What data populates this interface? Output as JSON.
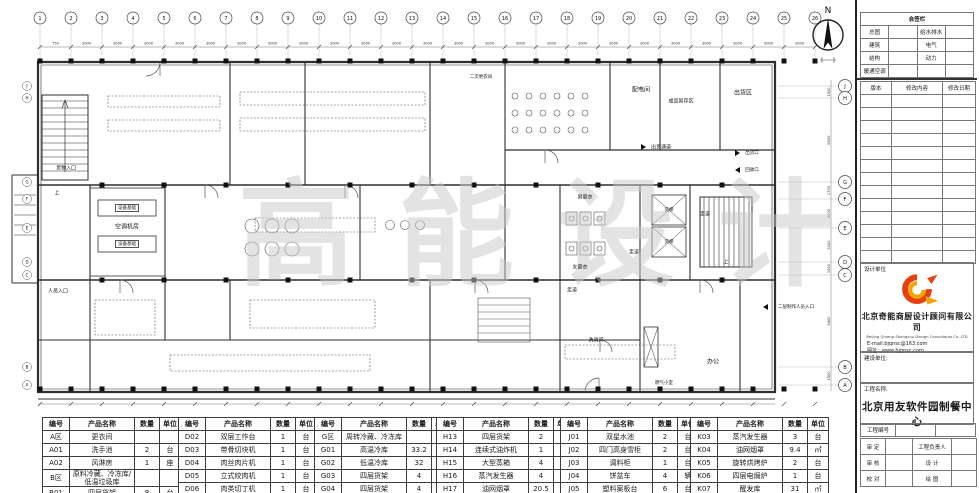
{
  "plan": {
    "north_label": "N",
    "watermark": "高能设计",
    "grid": {
      "top_numbers": [
        "1",
        "2",
        "3",
        "4",
        "5",
        "6",
        "7",
        "8",
        "9",
        "10",
        "11",
        "12",
        "13",
        "14",
        "15",
        "16",
        "17",
        "18",
        "19",
        "20",
        "21",
        "22",
        "23",
        "24",
        "25",
        "26"
      ],
      "top_dims": [
        "750",
        "3000",
        "3000",
        "3000",
        "3000",
        "3000",
        "3000",
        "3000",
        "3000",
        "3000",
        "3000",
        "3000",
        "3000",
        "3000",
        "3000",
        "3000",
        "3000",
        "3000",
        "3000",
        "3000",
        "3000",
        "3000",
        "3000",
        "3000",
        "3000"
      ],
      "right_letters": [
        "J",
        "H",
        "G",
        "F",
        "E",
        "D",
        "C",
        "B",
        "A"
      ],
      "right_dims": [
        "1500",
        "6000",
        "1700",
        "3000",
        "3000",
        "1500",
        "5400",
        "1500"
      ]
    },
    "labels": {
      "goods_entrance": "货物入口",
      "staff_entrance": "人员入口",
      "equipment_base": "设备基础",
      "ac_room": "空调机房",
      "second_dressing": "二次更衣间",
      "power_room": "配电间",
      "finished_storage": "成品暂存区",
      "shipping_area": "出货区",
      "shipping_corridor": "出货通道",
      "shipping_port": "出货口",
      "recycle_port": "回收口",
      "male_dressing": "男更衣",
      "female_dressing": "女更衣",
      "corridor": "走道",
      "freight_elevator": "货梯",
      "up": "上",
      "office": "办公",
      "gas_room": "燃气小室",
      "washing_room": "洗消间",
      "second_floor_entrance": "二层制作人员入口"
    }
  },
  "equipment_headers": [
    "编号",
    "产品名称",
    "数量",
    "单位"
  ],
  "equipment_tables": [
    {
      "rows": [
        [
          "A区",
          "更衣间",
          "",
          ""
        ],
        [
          "A01",
          "洗手池",
          "2",
          "台"
        ],
        [
          "A02",
          "风淋房",
          "1",
          "座"
        ],
        [
          "B区",
          "原料冷藏、冷冻库/低温垃圾库",
          "",
          ""
        ],
        [
          "B01",
          "四层货架",
          "8",
          "台"
        ]
      ]
    },
    {
      "rows": [
        [
          "D02",
          "双层工作台",
          "1",
          "台"
        ],
        [
          "D03",
          "带骨切块机",
          "1",
          "台"
        ],
        [
          "D04",
          "肉丝肉片机",
          "1",
          "台"
        ],
        [
          "D05",
          "立式绞肉机",
          "1",
          "台"
        ],
        [
          "D06",
          "肉类切丁机",
          "1",
          "台"
        ]
      ]
    },
    {
      "rows": [
        [
          "G区",
          "周转冷藏、冷冻库",
          "",
          ""
        ],
        [
          "G01",
          "高温冷库",
          "33.2",
          "㎡"
        ],
        [
          "G02",
          "低温冷库",
          "32",
          "㎡"
        ],
        [
          "G03",
          "四层货架",
          "4",
          "台"
        ],
        [
          "G04",
          "四层货架",
          "4",
          "台"
        ]
      ]
    },
    {
      "rows": [
        [
          "H13",
          "四层货架",
          "2",
          "台"
        ],
        [
          "H14",
          "连续式油炸机",
          "1",
          "台"
        ],
        [
          "H15",
          "大型蒸箱",
          "4",
          "台"
        ],
        [
          "H16",
          "蒸汽发生器",
          "4",
          "台"
        ],
        [
          "H17",
          "油网烟罩",
          "20.5",
          "㎡"
        ]
      ]
    },
    {
      "rows": [
        [
          "J01",
          "双星水池",
          "2",
          "台"
        ],
        [
          "J02",
          "四门高身雪柜",
          "2",
          "台"
        ],
        [
          "J03",
          "调料柜",
          "1",
          "台"
        ],
        [
          "J04",
          "饼盆车",
          "4",
          "辆"
        ],
        [
          "J05",
          "塑料案板台",
          "6",
          "台"
        ]
      ]
    },
    {
      "rows": [
        [
          "K03",
          "蒸汽发生器",
          "3",
          "台"
        ],
        [
          "K04",
          "油网烟罩",
          "9.4",
          "㎡"
        ],
        [
          "K05",
          "旋转烘烤炉",
          "2",
          "台"
        ],
        [
          "K06",
          "四层电焗炉",
          "1",
          "台"
        ],
        [
          "K07",
          "醒发库",
          "31",
          "㎡"
        ]
      ]
    }
  ],
  "title_block": {
    "sign_table": {
      "title": "会签栏",
      "rows": [
        [
          "总图",
          "",
          "给水排水",
          ""
        ],
        [
          "建筑",
          "",
          "电气",
          ""
        ],
        [
          "结构",
          "",
          "动力",
          ""
        ],
        [
          "暖通空调",
          "",
          "",
          ""
        ]
      ]
    },
    "revision_table": {
      "headers": [
        "版本",
        "修改内容",
        "修改日期"
      ],
      "empty_rows": 13
    },
    "design_unit_label": "设计单位",
    "company_cn": "北京奇能商厨设计顾问有限公司",
    "company_en": "Beijing Qineng Shangchu Design Consultants Co.,LTD",
    "email": "E-mail:bjqnsc@163.com",
    "website": "网址：www.bjqnsc.com",
    "build_unit_label": "建设单位:",
    "project_name_label": "工程名称:",
    "project_name": "北京用友软件园制餐中心",
    "project_no_row": [
      "工程编号",
      "",
      ""
    ],
    "approval_rows": [
      [
        "审 定",
        "",
        "工程负责人",
        ""
      ],
      [
        "审 核",
        "",
        "设 计",
        ""
      ],
      [
        "校 对",
        "",
        "绘 图",
        ""
      ]
    ]
  },
  "colors": {
    "line": "#2f2f2f",
    "watermark": "#c8c8c8",
    "logo_red": "#e5400e",
    "logo_orange": "#f3a40c"
  }
}
